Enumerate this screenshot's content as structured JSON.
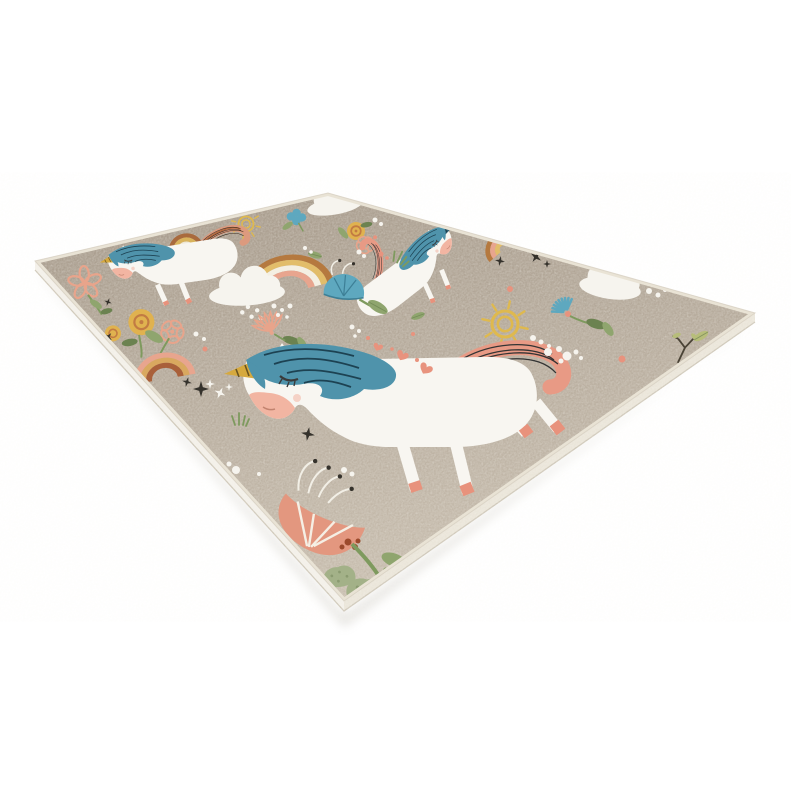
{
  "meta": {
    "description": "Product photo of a beige children's rug with unicorns, rainbows, clouds and flowers, shown in perspective on a white background",
    "background_color": "#ffffff"
  },
  "rug": {
    "quad": {
      "left": [
        35,
        261
      ],
      "top": [
        328,
        193
      ],
      "right": [
        755,
        313
      ],
      "bottom": [
        344,
        601
      ]
    },
    "thickness": 10,
    "surface_top_color": "#a89c8d",
    "surface_bottom_color": "#c9bfb0",
    "binding_color": "#e9e3d5",
    "side_left_color": "#f3f0e9",
    "side_right_color": "#eae5d9",
    "side_lip_color": "#cfc8b9",
    "shadow_color": "#a39d90"
  },
  "palette": {
    "unicornBody": "#f8f6f1",
    "mane": "#4f93ab",
    "maneLine": "#1d4252",
    "tailSalmon": "#e89a85",
    "tailLine": "#343434",
    "horn": "#d6a93e",
    "hornLine": "#6b5420",
    "muzzle": "#f2b5a2",
    "hoof": "#e8927c",
    "eyeDark": "#3a3a3a",
    "rainbow": [
      "#b5793f",
      "#e2bd6a",
      "#f4efe2",
      "#e8a58e"
    ],
    "cloudWhite": "#f6f4ee",
    "sunYellow": "#dfb94e",
    "blue": "#5ea8bf",
    "blueDark": "#3d7f96",
    "yellowFlower": "#e0b24f",
    "orangeRing": "#c27b43",
    "pinkOutline": "#e8a48b",
    "poppyPink": "#e3977f",
    "poppyDark": "#9c4a2c",
    "leafGreen": "#8fa56e",
    "leafDark": "#6b8250",
    "stemGreen": "#7e9a5e",
    "sageBush": "#a3b188",
    "sageDot": "#8a9a70",
    "yellowGreen": "#b7bd7a",
    "twig": "#4a4336",
    "dotWhite": "#f6f4ee",
    "dotSalmon": "#e8937e",
    "black": "#35322c"
  },
  "motifs": [
    {
      "type": "cloud",
      "name": "cloud-top-partial",
      "x": 335,
      "y": 206,
      "w": 56,
      "h": 17,
      "rotate": -10
    },
    {
      "type": "rainbow",
      "name": "rainbow-mini-back",
      "x": 186,
      "y": 249,
      "r": 15,
      "bw": 4.5,
      "squash": 0.9,
      "rotate": -14,
      "colors": [
        "#a96a3d",
        "#d9b35c",
        "#f0e9d8"
      ]
    },
    {
      "type": "rainbow",
      "name": "rainbow-large",
      "x": 288,
      "y": 293,
      "r": 44,
      "bw": 6.6,
      "squash": 0.8,
      "rotate": -14,
      "colors": [
        "#b5793f",
        "#e2bd6a",
        "#f4efe2",
        "#e8a58e"
      ]
    },
    {
      "type": "cloud",
      "name": "cloud-rain",
      "x": 247,
      "y": 294,
      "w": 76,
      "h": 23,
      "rotate": -4,
      "rain": [
        [
          0,
          13
        ],
        [
          9,
          17
        ],
        [
          3,
          23
        ],
        [
          12,
          25
        ],
        [
          -6,
          18
        ]
      ]
    },
    {
      "type": "sun",
      "name": "sun-small",
      "x": 246,
      "y": 224,
      "r": 7.5
    },
    {
      "type": "flower-blue-small",
      "name": "flower-blue-top",
      "x": 296,
      "y": 218,
      "rotate": -5
    },
    {
      "type": "flower-mixed",
      "name": "flower-cluster-topright",
      "x": 356,
      "y": 231,
      "rotate": 24
    },
    {
      "type": "leaf",
      "name": "leaf-top-mid",
      "x": 315,
      "y": 255,
      "rotate": 15,
      "w": 7,
      "h": 3.2
    },
    {
      "type": "unicorn",
      "name": "unicorn-small-left",
      "x": 178,
      "y": 263,
      "scale": 0.44,
      "rotate": -8,
      "flip": false,
      "tailAngle": -8,
      "legsX": -55,
      "colors": {
        "tail": "#dc9a7e",
        "tailLine": "#3c2d20",
        "tailAccent": "#b5693f"
      }
    },
    {
      "type": "unicorn",
      "name": "unicorn-small-right",
      "x": 405,
      "y": 277,
      "scale": 0.4,
      "rotate": -38,
      "flip": true,
      "tailAngle": -120,
      "legsX": -85,
      "colors": {
        "horn": "#2f5d70",
        "hornLine": "#16303a"
      }
    },
    {
      "type": "rainbow",
      "name": "rainbow-small-right",
      "x": 504,
      "y": 249,
      "r": 17,
      "bw": 5,
      "squash": 0.9,
      "rotate": -42,
      "colors": [
        "#b5793f",
        "#e8a58e",
        "#e2bd6a"
      ]
    },
    {
      "type": "stars-black",
      "name": "sparkles-black-right",
      "pts": [
        [
          500,
          261,
          5,
          10
        ],
        [
          536,
          257,
          6,
          35
        ],
        [
          547,
          264,
          4,
          0
        ]
      ]
    },
    {
      "type": "cloud",
      "name": "cloud-right",
      "x": 610,
      "y": 288,
      "w": 62,
      "h": 22,
      "rotate": 8
    },
    {
      "type": "grass",
      "name": "grass-tuft-top",
      "x": 398,
      "y": 263,
      "rotate": 25
    },
    {
      "type": "flower-tuft",
      "name": "flower-tuft-blue",
      "x": 566,
      "y": 312,
      "rotate": 0
    },
    {
      "type": "sun",
      "name": "sun-large",
      "x": 505,
      "y": 324,
      "r": 13
    },
    {
      "type": "sprig",
      "name": "sprig-right",
      "x": 680,
      "y": 347,
      "rotate": 8
    },
    {
      "type": "leaf",
      "name": "leaf-right",
      "x": 701,
      "y": 336,
      "rotate": -30,
      "w": 8,
      "h": 3.8,
      "fill": "yellowGreen"
    },
    {
      "type": "flower-yellow-cluster",
      "name": "flower-cluster-left",
      "x": 140,
      "y": 330,
      "rotate": 10
    },
    {
      "type": "flower-pink-outline",
      "name": "flower-pink-left",
      "x": 85,
      "y": 283,
      "rotate": -5
    },
    {
      "type": "flower-pink-fan",
      "name": "flower-pink-mid",
      "x": 271,
      "y": 331,
      "rotate": -20
    },
    {
      "type": "flower-blue-fan",
      "name": "flower-bluebell",
      "x": 344,
      "y": 292,
      "rotate": 5
    },
    {
      "type": "rainbow",
      "name": "rainbow-small-left",
      "x": 165,
      "y": 379,
      "r": 28,
      "bw": 6,
      "squash": 0.85,
      "rotate": -10,
      "colors": [
        "#e8a58e",
        "#d9a85f",
        "#a9603a"
      ]
    },
    {
      "type": "stars-black",
      "name": "sparkles-black-left",
      "pts": [
        [
          187,
          382,
          5,
          15
        ],
        [
          201,
          389,
          8,
          0
        ],
        [
          108,
          302,
          4,
          20
        ],
        [
          108,
          337,
          5,
          40
        ],
        [
          308,
          434,
          7,
          10
        ]
      ]
    },
    {
      "type": "stars-white",
      "name": "sparkles-white-left",
      "pts": [
        [
          210,
          384,
          5,
          0
        ],
        [
          220,
          393,
          6,
          25
        ],
        [
          229,
          387,
          4,
          0
        ]
      ]
    },
    {
      "type": "unicorn",
      "name": "unicorn-large",
      "x": 400,
      "y": 400,
      "scale": 1,
      "rotate": 0,
      "flip": false,
      "tailAngle": 0,
      "legsX": 0,
      "colors": {}
    },
    {
      "type": "hearts",
      "name": "hearts-trail",
      "items": [
        [
          379,
          344,
          0.8,
          20
        ],
        [
          404,
          352,
          1.0,
          25
        ],
        [
          428,
          365,
          1.1,
          30
        ]
      ],
      "dots": [
        [
          368,
          338,
          2
        ],
        [
          392,
          349,
          1.8
        ],
        [
          413,
          334,
          2
        ],
        [
          417,
          360,
          2
        ]
      ]
    },
    {
      "type": "poppy",
      "name": "flower-poppy",
      "x": 322,
      "y": 520,
      "rotate": 26
    },
    {
      "type": "bush",
      "name": "bush-near-corner-1",
      "x": 340,
      "y": 577,
      "scale": 1.0,
      "rotate": -6
    },
    {
      "type": "bush",
      "name": "bush-near-corner-2",
      "x": 366,
      "y": 591,
      "scale": 1.15,
      "rotate": 10
    },
    {
      "type": "cloud",
      "name": "cloud-left-partial",
      "x": 152,
      "y": 452,
      "w": 44,
      "h": 15,
      "rotate": 24
    },
    {
      "type": "grass",
      "name": "grass-tuft-bottom",
      "x": 240,
      "y": 425,
      "rotate": 0
    },
    {
      "type": "leaf",
      "name": "leaf-mid-right",
      "x": 418,
      "y": 316,
      "rotate": -20,
      "w": 7,
      "h": 3.2
    },
    {
      "type": "dots",
      "name": "dots-white-top",
      "fill": "dotWhite",
      "pts": [
        [
          375,
          220,
          2.5
        ],
        [
          381,
          224,
          2
        ],
        [
          359,
          252,
          2.5
        ],
        [
          364,
          256,
          2
        ],
        [
          305,
          248,
          2
        ],
        [
          311,
          252,
          1.8
        ],
        [
          196,
          334,
          2.5
        ],
        [
          204,
          339,
          2
        ]
      ]
    },
    {
      "type": "dots",
      "name": "dots-white-right",
      "fill": "dotWhite",
      "pts": [
        [
          548,
          352,
          4
        ],
        [
          559,
          349,
          3
        ],
        [
          567,
          356,
          4.5
        ],
        [
          576,
          352,
          2.5
        ],
        [
          561,
          361,
          2.5
        ],
        [
          581,
          358,
          2
        ],
        [
          533,
          338,
          3
        ],
        [
          541,
          342,
          2.5
        ],
        [
          549,
          346,
          2
        ]
      ]
    },
    {
      "type": "dots",
      "name": "dots-white-mid",
      "fill": "dotWhite",
      "pts": [
        [
          649,
          291,
          3
        ],
        [
          658,
          295,
          2.5
        ],
        [
          665,
          290,
          2
        ],
        [
          274,
          306,
          2.5
        ],
        [
          282,
          310,
          2
        ],
        [
          290,
          306,
          2.5
        ],
        [
          278,
          315,
          2
        ],
        [
          287,
          317,
          1.8
        ],
        [
          352,
          327,
          2.5
        ],
        [
          359,
          331,
          2
        ],
        [
          355,
          336,
          1.8
        ],
        [
          344,
          470,
          3
        ],
        [
          352,
          474,
          2.5
        ],
        [
          236,
          470,
          4
        ],
        [
          229,
          464,
          2.5
        ],
        [
          259,
          474,
          2
        ]
      ]
    },
    {
      "type": "dots",
      "name": "dots-salmon",
      "fill": "dotSalmon",
      "pts": [
        [
          381,
          254,
          2.5
        ],
        [
          387,
          258,
          1.8
        ],
        [
          622,
          359,
          3.5
        ],
        [
          41,
          371,
          2.5
        ],
        [
          47,
          376,
          2
        ],
        [
          510,
          289,
          3
        ],
        [
          205,
          349,
          2.5
        ],
        [
          66,
          333,
          2
        ]
      ]
    }
  ]
}
